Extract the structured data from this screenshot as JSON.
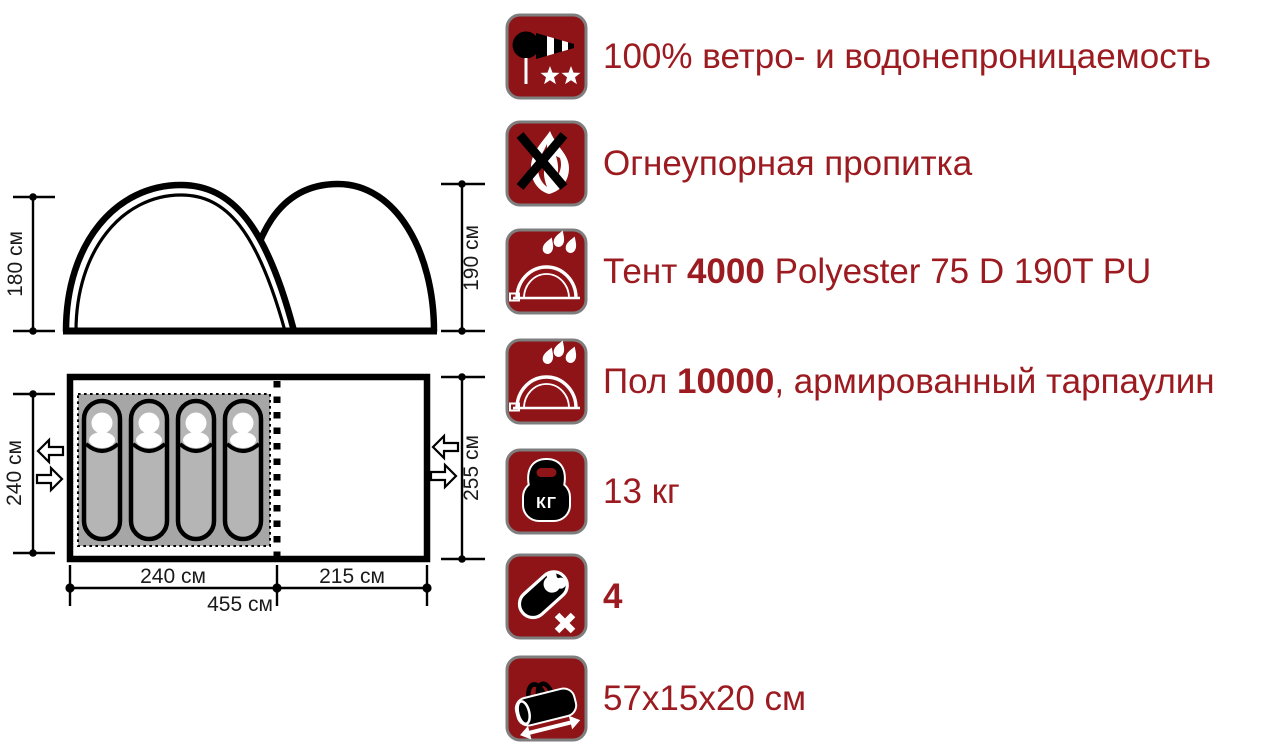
{
  "colors": {
    "icon_bg": "#8e1418",
    "icon_border": "#7e7e7e",
    "feature_text": "#9c1b20",
    "diagram_line": "#000000",
    "icon_art": "#ffffff",
    "sleep_area_fill": "#a6a6a6",
    "bag_fill": "#b5b5b5"
  },
  "diagram": {
    "side_view": {
      "height_left": "180 см",
      "height_right": "190 см"
    },
    "floor_plan": {
      "depth_left": "240 см",
      "depth_right": "255 см",
      "width_inner": "240 см",
      "width_vestibule": "215 см",
      "width_total": "455 см",
      "sleeping_spots": 4
    }
  },
  "features": [
    {
      "icon": "windsock-icon",
      "prefix": "100% ветро- и водонепроницаемость",
      "bold": "",
      "suffix": ""
    },
    {
      "icon": "no-fire-icon",
      "prefix": "Огнеупорная пропитка",
      "bold": "",
      "suffix": ""
    },
    {
      "icon": "tent-rain-icon",
      "prefix": "Тент ",
      "bold": "4000",
      "suffix": " Polyester 75 D 190T PU"
    },
    {
      "icon": "floor-rain-icon",
      "prefix": "Пол ",
      "bold": "10000",
      "suffix": ", армированный тарпаулин"
    },
    {
      "icon": "weight-kettlebell-icon",
      "prefix": "13 кг",
      "bold": "",
      "suffix": "",
      "icon_label": "КГ"
    },
    {
      "icon": "sleeping-bag-capacity-icon",
      "prefix": "",
      "bold": "4",
      "suffix": ""
    },
    {
      "icon": "packed-size-bag-icon",
      "prefix": "57x15x20 см",
      "bold": "",
      "suffix": ""
    }
  ]
}
